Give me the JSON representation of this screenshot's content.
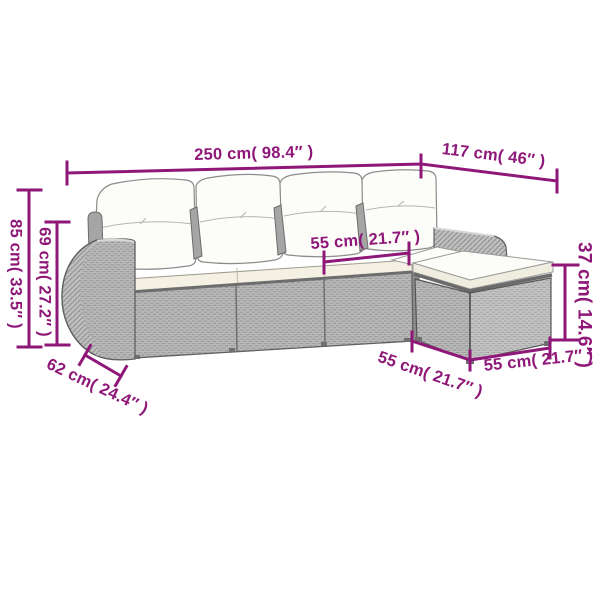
{
  "diagram": {
    "title": "sofa-set-dimension-diagram",
    "colors": {
      "accent": "#8E1778",
      "wicker": "#BDBDBD",
      "wicker_light": "#C8C8C8",
      "hatch": "#8A8A8A",
      "outline": "#5F5F5F",
      "cushion": "#FCFCF9",
      "seat_cushion": "#F4F1E4"
    },
    "labels": {
      "total_length": "250 cm( 98.4″ )",
      "total_depth": "117 cm( 46″ )",
      "overall_height": "85 cm( 33.5″ )",
      "backrest_height": "69 cm( 27.2″ )",
      "seat_width": "55 cm( 21.7″ )",
      "armrest_depth": "62 cm( 24.4″ )",
      "footstool_height": "37 cm( 14.6″ )",
      "footstool_front_width": "55 cm( 21.7″ )",
      "footstool_side_width": "55 cm( 21.7″ )"
    }
  }
}
